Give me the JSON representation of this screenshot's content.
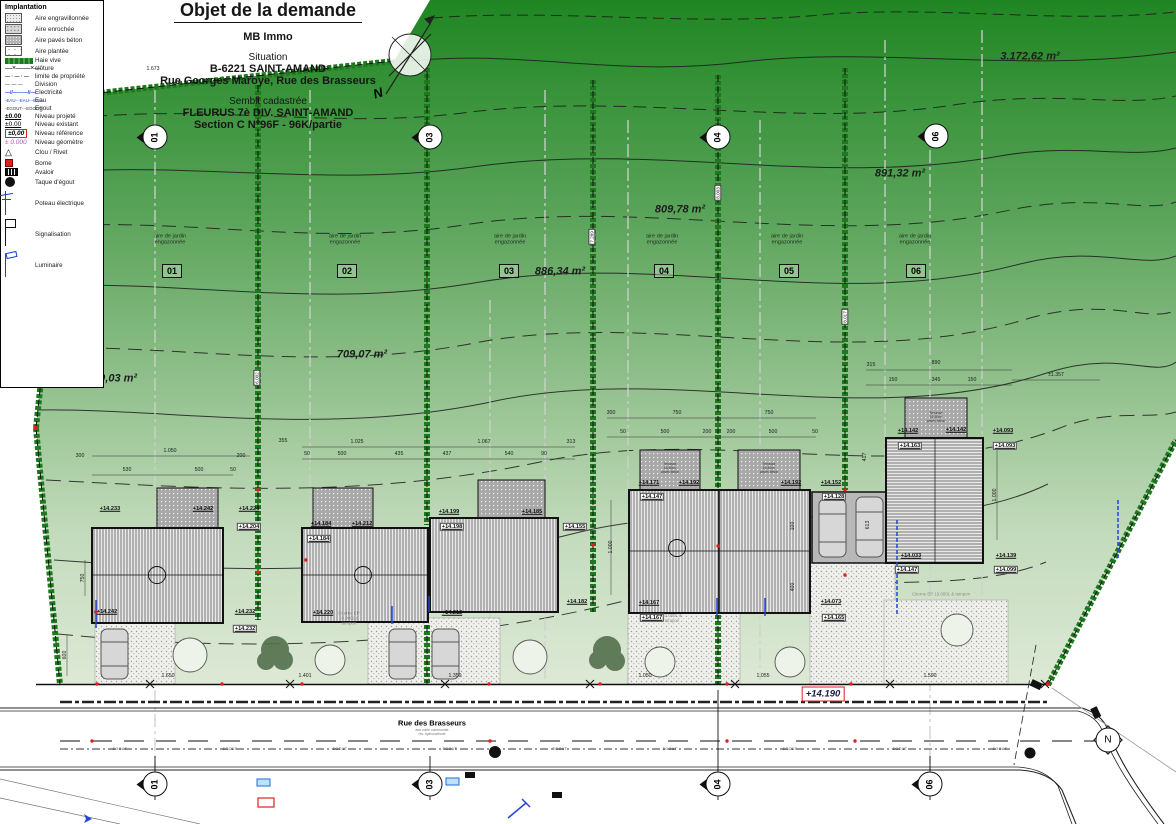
{
  "title_block": {
    "title": "Objet de la demande",
    "applicant": "MB Immo",
    "situation_label": "Situation",
    "situation_line1": "B-6221 SAINT-AMAND",
    "situation_line2": "Rue Georges Maroye,   Rue des Brasseurs",
    "cadastre_label": "Semblt cadastrée",
    "cadastre_line1": "FLEURUS 7è DIV. SAINT-AMAND",
    "cadastre_line2": "Section C N°96F - 96K/partie"
  },
  "legend": {
    "title": "Implantation",
    "items": [
      {
        "type": "swatch-gravel",
        "label": "Aire engravillonnée"
      },
      {
        "type": "swatch-rock",
        "label": "Aire enrochée"
      },
      {
        "type": "swatch-paves",
        "label": "Aire pavés béton"
      },
      {
        "type": "swatch-planted",
        "label": "Aire plantée"
      },
      {
        "type": "line-hedge",
        "label": "Haie vive"
      },
      {
        "type": "line-fence",
        "label": "clôture",
        "value": "—×——×—"
      },
      {
        "type": "line-property",
        "label": "limite de propriété",
        "value": "— · — · —"
      },
      {
        "type": "line-division",
        "label": "Division",
        "value": "—  —  —"
      },
      {
        "type": "line-elec",
        "label": "Electricité",
        "value": "—//———//—"
      },
      {
        "type": "line-eau",
        "label": "Eau",
        "value": "-EAU-·-EAU-·-EAU-"
      },
      {
        "type": "line-egout",
        "label": "Egout",
        "value": "-EGOUT-·-EGOUT-"
      },
      {
        "type": "level-proj",
        "label": "Niveau projeté",
        "value": "±0.00"
      },
      {
        "type": "level-exist",
        "label": "Niveau existant",
        "value": "±0.00"
      },
      {
        "type": "level-ref",
        "label": "Niveau référence",
        "value": "±0,00"
      },
      {
        "type": "level-geo",
        "label": "Niveau géomètre",
        "value": "± 0.000"
      },
      {
        "type": "sym-clou",
        "label": "Clou / Rivet",
        "value": "△"
      },
      {
        "type": "sym-borne",
        "label": "Borne"
      },
      {
        "type": "sym-avaloir",
        "label": "Avaloir"
      },
      {
        "type": "sym-taque",
        "label": "Taque d'égout"
      },
      {
        "type": "sym-poteau",
        "label": "Poteau électrique"
      },
      {
        "type": "sym-signal",
        "label": "Signalisation"
      },
      {
        "type": "sym-lum",
        "label": "Luminaire"
      }
    ]
  },
  "plan": {
    "north_label": "N",
    "reference_level": "+14.190",
    "garden_label": "aire de jardin\nengazonnée",
    "terrace_label": "Terrasse\n16,50m²\npavés béton",
    "areas": [
      {
        "t": "840,03 m²",
        "x": 112,
        "y": 379
      },
      {
        "t": "709,07 m²",
        "x": 362,
        "y": 355
      },
      {
        "t": "886,34 m²",
        "x": 560,
        "y": 272
      },
      {
        "t": "809,78 m²",
        "x": 680,
        "y": 210
      },
      {
        "t": "891,32 m²",
        "x": 900,
        "y": 174
      },
      {
        "t": "3.172,62 m²",
        "x": 1030,
        "y": 57
      }
    ],
    "garden_positions": [
      {
        "x": 170,
        "y": 240
      },
      {
        "x": 345,
        "y": 240
      },
      {
        "x": 510,
        "y": 240
      },
      {
        "x": 662,
        "y": 240
      },
      {
        "x": 787,
        "y": 240
      },
      {
        "x": 915,
        "y": 240
      }
    ],
    "lots": [
      {
        "n": "01",
        "x": 172,
        "y": 271
      },
      {
        "n": "02",
        "x": 347,
        "y": 271
      },
      {
        "n": "03",
        "x": 509,
        "y": 271
      },
      {
        "n": "04",
        "x": 664,
        "y": 271
      },
      {
        "n": "05",
        "x": 789,
        "y": 271
      },
      {
        "n": "06",
        "x": 916,
        "y": 271
      }
    ],
    "markers": [
      {
        "n": "01",
        "x": 155,
        "y": 137
      },
      {
        "n": "03",
        "x": 430,
        "y": 137
      },
      {
        "n": "04",
        "x": 718,
        "y": 137
      },
      {
        "n": "06",
        "x": 936,
        "y": 136
      },
      {
        "n": "01",
        "x": 155,
        "y": 784
      },
      {
        "n": "03",
        "x": 430,
        "y": 784
      },
      {
        "n": "04",
        "x": 718,
        "y": 784
      },
      {
        "n": "06",
        "x": 930,
        "y": 784
      },
      {
        "n": "N",
        "x": 1108,
        "y": 740,
        "north": true
      }
    ],
    "elevations": [
      {
        "t": "+14.233",
        "x": 110,
        "y": 509
      },
      {
        "t": "+14.242",
        "x": 203,
        "y": 509
      },
      {
        "t": "+14.224",
        "x": 249,
        "y": 509
      },
      {
        "t": "+14.204",
        "x": 249,
        "y": 527,
        "b": 1
      },
      {
        "t": "+14.242",
        "x": 107,
        "y": 612
      },
      {
        "t": "+14.232",
        "x": 245,
        "y": 612
      },
      {
        "t": "+14.232",
        "x": 245,
        "y": 629,
        "b": 1
      },
      {
        "t": "+14.184",
        "x": 321,
        "y": 524
      },
      {
        "t": "+14.212",
        "x": 362,
        "y": 524
      },
      {
        "t": "+14.184",
        "x": 319,
        "y": 539,
        "b": 1
      },
      {
        "t": "+14.220",
        "x": 323,
        "y": 613
      },
      {
        "t": "+14.199",
        "x": 449,
        "y": 512
      },
      {
        "t": "+14.198",
        "x": 452,
        "y": 527,
        "b": 1
      },
      {
        "t": "+14.185",
        "x": 532,
        "y": 512
      },
      {
        "t": "+14.155",
        "x": 575,
        "y": 527,
        "b": 1
      },
      {
        "t": "+14.182",
        "x": 577,
        "y": 602
      },
      {
        "t": "+14.212",
        "x": 452,
        "y": 613
      },
      {
        "t": "+14.171",
        "x": 649,
        "y": 483
      },
      {
        "t": "+14.192",
        "x": 689,
        "y": 483
      },
      {
        "t": "+14.192",
        "x": 791,
        "y": 483
      },
      {
        "t": "+14.152",
        "x": 831,
        "y": 483
      },
      {
        "t": "+14.147",
        "x": 652,
        "y": 497,
        "b": 1
      },
      {
        "t": "+14.128",
        "x": 834,
        "y": 497,
        "b": 1
      },
      {
        "t": "+14.167",
        "x": 649,
        "y": 603
      },
      {
        "t": "+14.167",
        "x": 652,
        "y": 618,
        "b": 1
      },
      {
        "t": "+14.073",
        "x": 831,
        "y": 602
      },
      {
        "t": "+14.165",
        "x": 834,
        "y": 618,
        "b": 1
      },
      {
        "t": "+14.142",
        "x": 908,
        "y": 431
      },
      {
        "t": "+14.142",
        "x": 956,
        "y": 430
      },
      {
        "t": "+14.093",
        "x": 1003,
        "y": 431
      },
      {
        "t": "+14.163",
        "x": 910,
        "y": 446,
        "b": 1
      },
      {
        "t": "+14.093",
        "x": 1005,
        "y": 446,
        "b": 1
      },
      {
        "t": "+14.033",
        "x": 911,
        "y": 556
      },
      {
        "t": "+14.139",
        "x": 1006,
        "y": 556
      },
      {
        "t": "+14.147",
        "x": 907,
        "y": 570,
        "b": 1
      },
      {
        "t": "+14.099",
        "x": 1006,
        "y": 570,
        "b": 1
      }
    ],
    "dimensions": [
      {
        "t": "1.673",
        "x": 153,
        "y": 70
      },
      {
        "t": "1.121",
        "x": 322,
        "y": 70
      },
      {
        "t": "300",
        "x": 80,
        "y": 457
      },
      {
        "t": "1.050",
        "x": 170,
        "y": 452
      },
      {
        "t": "530",
        "x": 127,
        "y": 471
      },
      {
        "t": "500",
        "x": 199,
        "y": 471
      },
      {
        "t": "50",
        "x": 233,
        "y": 471
      },
      {
        "t": "200",
        "x": 241,
        "y": 457
      },
      {
        "t": "355",
        "x": 283,
        "y": 442
      },
      {
        "t": "1.025",
        "x": 357,
        "y": 443
      },
      {
        "t": "1.067",
        "x": 484,
        "y": 443
      },
      {
        "t": "313",
        "x": 571,
        "y": 443
      },
      {
        "t": "50",
        "x": 307,
        "y": 455
      },
      {
        "t": "500",
        "x": 342,
        "y": 455
      },
      {
        "t": "435",
        "x": 399,
        "y": 455
      },
      {
        "t": "437",
        "x": 447,
        "y": 455
      },
      {
        "t": "540",
        "x": 509,
        "y": 455
      },
      {
        "t": "90",
        "x": 544,
        "y": 455
      },
      {
        "t": "300",
        "x": 611,
        "y": 414
      },
      {
        "t": "750",
        "x": 677,
        "y": 414
      },
      {
        "t": "750",
        "x": 769,
        "y": 414
      },
      {
        "t": "50",
        "x": 623,
        "y": 433
      },
      {
        "t": "500",
        "x": 665,
        "y": 433
      },
      {
        "t": "200",
        "x": 707,
        "y": 433
      },
      {
        "t": "200",
        "x": 731,
        "y": 433
      },
      {
        "t": "500",
        "x": 773,
        "y": 433
      },
      {
        "t": "50",
        "x": 815,
        "y": 433
      },
      {
        "t": "315",
        "x": 871,
        "y": 366
      },
      {
        "t": "890",
        "x": 936,
        "y": 364
      },
      {
        "t": "150",
        "x": 893,
        "y": 381
      },
      {
        "t": "345",
        "x": 936,
        "y": 381
      },
      {
        "t": "150",
        "x": 972,
        "y": 381
      },
      {
        "t": "±1.357",
        "x": 1056,
        "y": 376
      },
      {
        "t": "1.650",
        "x": 168,
        "y": 677
      },
      {
        "t": "1.401",
        "x": 305,
        "y": 677
      },
      {
        "t": "1.359",
        "x": 455,
        "y": 677
      },
      {
        "t": "1.050",
        "x": 645,
        "y": 677
      },
      {
        "t": "1.055",
        "x": 763,
        "y": 677
      },
      {
        "t": "1.590",
        "x": 930,
        "y": 677
      },
      {
        "t": "600",
        "x": 66,
        "y": 655,
        "v": 1
      },
      {
        "t": "750",
        "x": 84,
        "y": 578,
        "v": 1
      },
      {
        "t": "1.000",
        "x": 612,
        "y": 547,
        "v": 1
      },
      {
        "t": "100",
        "x": 794,
        "y": 526,
        "v": 1
      },
      {
        "t": "400",
        "x": 794,
        "y": 587,
        "v": 1
      },
      {
        "t": "613",
        "x": 869,
        "y": 525,
        "v": 1
      },
      {
        "t": "417",
        "x": 866,
        "y": 457,
        "v": 1
      },
      {
        "t": "1.000",
        "x": 996,
        "y": 495,
        "v": 1
      }
    ],
    "hedge_lengths": [
      {
        "t": "6.002",
        "x": 257,
        "y": 378
      },
      {
        "t": "7.289",
        "x": 592,
        "y": 237
      },
      {
        "t": "8.003",
        "x": 718,
        "y": 193
      },
      {
        "t": "8.017",
        "x": 845,
        "y": 317
      }
    ],
    "terrace_positions": [
      {
        "x": 670,
        "y": 469
      },
      {
        "x": 769,
        "y": 469
      },
      {
        "x": 936,
        "y": 418
      }
    ],
    "cisterns": [
      {
        "t": "Citerne EP\n10.000L &\ntampon",
        "x": 349,
        "y": 618
      },
      {
        "t": "10.000L &\ntampon",
        "x": 672,
        "y": 618
      },
      {
        "t": "Citerne EP 10.000L & tampon",
        "x": 941,
        "y": 594
      }
    ]
  },
  "street": {
    "name": "Rue des Brasseurs",
    "sub1": "axe voirie communale",
    "sub2": "rev. hydrocarboné",
    "egout_label": "EGOUT",
    "egout_positions": [
      120,
      230,
      340,
      450,
      560,
      670,
      790,
      900,
      1000
    ]
  }
}
